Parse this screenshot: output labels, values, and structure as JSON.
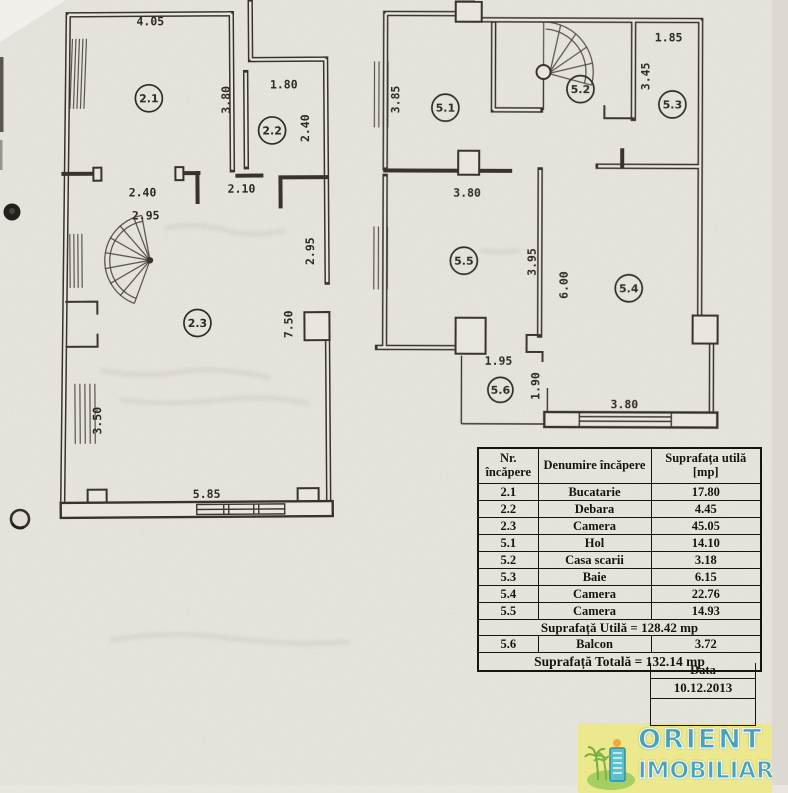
{
  "left_plan": {
    "rooms": [
      "2.1",
      "2.2",
      "2.3"
    ],
    "dims": {
      "top_21": "4.05",
      "right_21": "3.80",
      "top_22": "1.80",
      "right_22": "2.40",
      "door_21": "2.40",
      "door_hall": "2.10",
      "stair": "2.95",
      "right_up": "2.95",
      "right_full": "7.50",
      "left_low": "3.50",
      "bottom": "5.85"
    }
  },
  "right_plan": {
    "rooms": [
      "5.1",
      "5.2",
      "5.3",
      "5.4",
      "5.5",
      "5.6"
    ],
    "dims": {
      "left_51": "3.85",
      "top_53": "1.85",
      "left_53": "3.45",
      "door_51": "3.80",
      "mid_left": "3.95",
      "mid_right": "6.00",
      "balc_w": "1.95",
      "balc_h": "1.90",
      "bottom_54": "3.80"
    }
  },
  "table": {
    "headers": [
      "Nr. încăpere",
      "Denumire încăpere",
      "Suprafața utilă [mp]"
    ],
    "rows": [
      [
        "2.1",
        "Bucatarie",
        "17.80"
      ],
      [
        "2.2",
        "Debara",
        "4.45"
      ],
      [
        "2.3",
        "Camera",
        "45.05"
      ],
      [
        "5.1",
        "Hol",
        "14.10"
      ],
      [
        "5.2",
        "Casa scarii",
        "3.18"
      ],
      [
        "5.3",
        "Baie",
        "6.15"
      ],
      [
        "5.4",
        "Camera",
        "22.76"
      ],
      [
        "5.5",
        "Camera",
        "14.93"
      ]
    ],
    "subtotal": "Suprafață Utilă = 128.42 mp",
    "balcony_row": [
      "5.6",
      "Balcon",
      "3.72"
    ],
    "total": "Suprafață Totală = 132.14  mp",
    "date_label": "Data",
    "date_value": "10.12.2013"
  },
  "logo": {
    "line1": "ORIENT",
    "line2": "IMOBILIAR"
  },
  "colors": {
    "paper": "#e9e6e0",
    "ink": "#38342c",
    "table_ink": "#17140f",
    "logo_bg": "#ebe88e",
    "logo_text": "#47a2ba"
  }
}
